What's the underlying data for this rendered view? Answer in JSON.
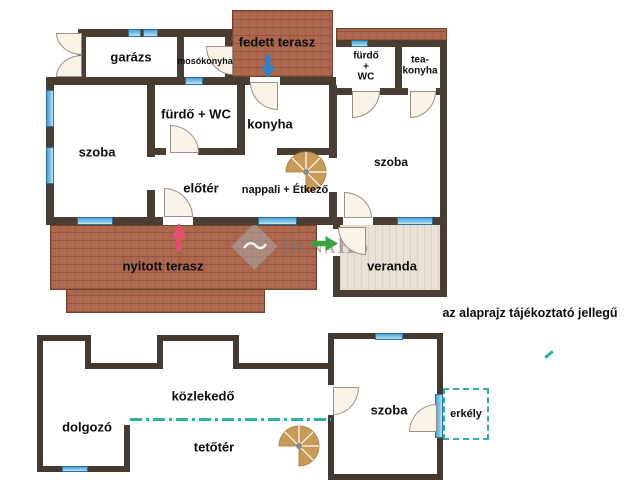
{
  "disclaimer": "az alaprajz tájékoztató jellegű",
  "watermark": {
    "brand": "DunaHo",
    "logo_icon": "duna-house-diamond-wave"
  },
  "upper": {
    "garage": "garázs",
    "laundry": "mosókonyha",
    "covered_terrace": "fedett terasz",
    "bath_wc": "fürdő + WC",
    "kitchen": "konyha",
    "room_left": "szoba",
    "hall": "előtér",
    "living": "nappali + Étkező",
    "bath_small": "fürdő\n+\nWC",
    "tea_kitchen": "tea-\nkonyha",
    "room_right": "szoba",
    "open_terrace": "nyitott terasz",
    "veranda": "veranda"
  },
  "lower": {
    "study": "dolgozó",
    "corridor": "közlekedő",
    "attic": "tetőtér",
    "room": "szoba",
    "balcony": "erkély"
  },
  "icons": {
    "entrance_main": "blue-down-arrow",
    "entrance_terrace": "pink-up-arrow",
    "entrance_veranda": "green-right-arrow",
    "stairs_upper": "spiral-staircase",
    "stairs_lower": "spiral-staircase"
  },
  "colors": {
    "wall": "#4a3e33",
    "brick": "#ad6850",
    "veranda_floor": "#e9e1d4",
    "window": "#7ec2e8",
    "teal_dash": "#2bb3a0",
    "stair": "#c79a58",
    "arrow_blue": "#2f83cc",
    "arrow_pink": "#e24e6e",
    "arrow_green": "#3da23d"
  }
}
